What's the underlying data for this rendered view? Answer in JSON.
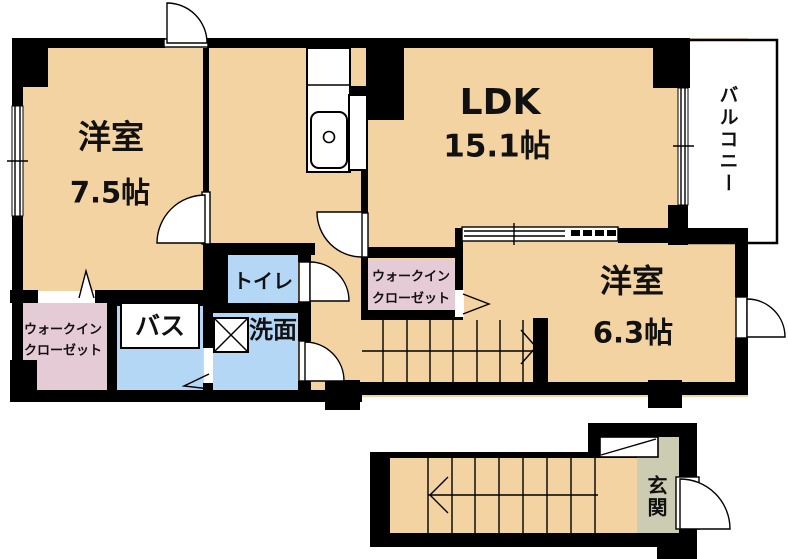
{
  "floorplan": {
    "rooms": {
      "western_room_1": {
        "name": "洋室",
        "size": "7.5帖"
      },
      "ldk": {
        "name": "LDK",
        "size": "15.1帖"
      },
      "western_room_2": {
        "name": "洋室",
        "size": "6.3帖"
      },
      "balcony": {
        "name": "バルコニー"
      },
      "toilet": {
        "name": "トイレ"
      },
      "bath": {
        "name": "バス"
      },
      "washroom": {
        "name": "洗面"
      },
      "walk_in_closet": {
        "line1": "ウォークイン",
        "line2": "クローゼット"
      },
      "entrance": {
        "name": "玄関"
      }
    },
    "colors": {
      "floor_tan": "#F2D3A1",
      "closet_pink": "#E5CBD6",
      "wet_blue": "#B5D7F6",
      "entrance_olive": "#CCCCB2",
      "wall_black": "#000000",
      "white": "#FFFFFF"
    }
  }
}
